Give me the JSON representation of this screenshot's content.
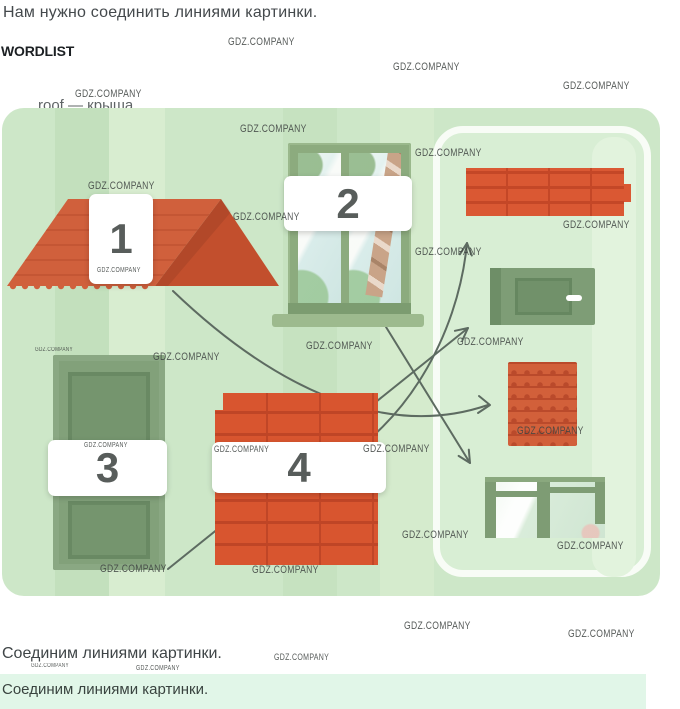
{
  "page": {
    "title": "Нам нужно соединить линиями картинки.",
    "wordlist_heading": "WORDLIST",
    "wordlist_entry_partial": "roof — крыша",
    "answer_caption": "Соединим линиями картинки.",
    "answer_caption_repeat": "Соединим линиями картинки."
  },
  "watermark": {
    "text": "GDZ.COMPANY",
    "positions": [
      [
        228,
        36,
        11
      ],
      [
        393,
        61,
        11
      ],
      [
        563,
        80,
        11
      ],
      [
        75,
        88,
        11
      ],
      [
        240,
        123,
        11
      ],
      [
        415,
        147,
        11
      ],
      [
        88,
        180,
        11
      ],
      [
        233,
        211,
        11
      ],
      [
        563,
        219,
        11
      ],
      [
        415,
        246,
        11
      ],
      [
        97,
        267,
        7
      ],
      [
        35,
        347,
        6
      ],
      [
        153,
        351,
        11
      ],
      [
        306,
        340,
        11
      ],
      [
        457,
        336,
        11
      ],
      [
        84,
        442,
        7
      ],
      [
        214,
        444,
        9
      ],
      [
        363,
        443,
        11
      ],
      [
        517,
        425,
        11
      ],
      [
        402,
        529,
        11
      ],
      [
        557,
        540,
        11
      ],
      [
        100,
        563,
        11
      ],
      [
        252,
        564,
        11
      ],
      [
        404,
        620,
        11
      ],
      [
        568,
        628,
        11
      ],
      [
        274,
        652,
        9
      ],
      [
        31,
        663,
        6
      ],
      [
        136,
        665,
        7
      ]
    ]
  },
  "exercise": {
    "numbered_pictures": [
      {
        "number": "1",
        "object": "roof"
      },
      {
        "number": "2",
        "object": "window"
      },
      {
        "number": "3",
        "object": "door"
      },
      {
        "number": "4",
        "object": "brick chimney"
      }
    ],
    "match_pictures": [
      "brick wall",
      "door",
      "roof tiles",
      "window"
    ],
    "connections": [
      {
        "from": "1",
        "to": "roof tiles"
      },
      {
        "from": "2",
        "to": "window"
      },
      {
        "from": "3",
        "to": "door"
      },
      {
        "from": "4",
        "to": "brick wall"
      }
    ]
  },
  "colors": {
    "panel_green": "#cde7c8",
    "panel_stripe_dark": "#c3e0bd",
    "panel_stripe_light": "#d8edd0",
    "brick_red": "#d8552f",
    "roof_red": "#d0603c",
    "door_green": "#7e9d76",
    "arrow": "#5d6b61",
    "mint_band": "#e1f6e8"
  }
}
